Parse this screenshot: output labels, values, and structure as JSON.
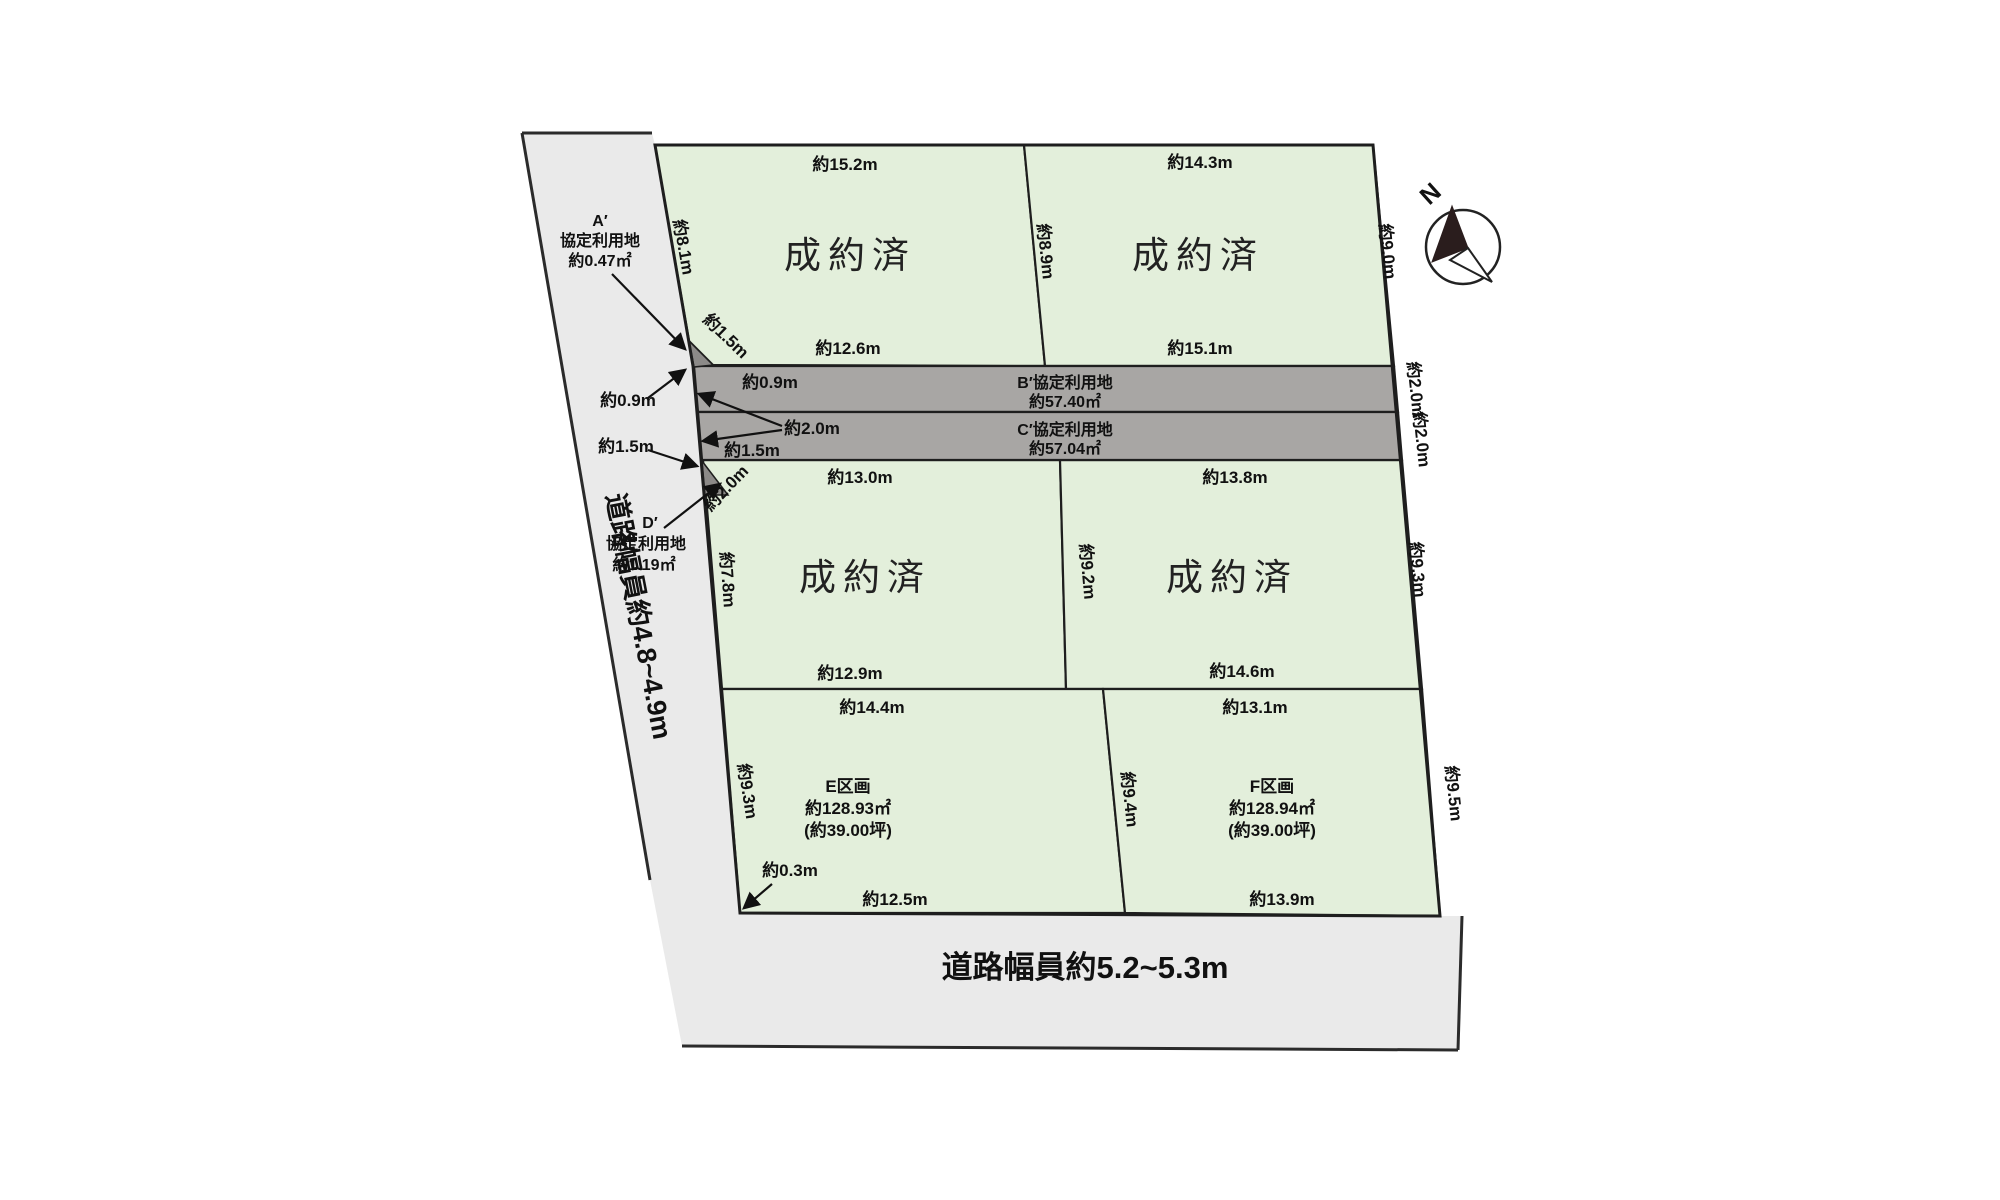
{
  "compass": {
    "north_label": "N"
  },
  "roads": {
    "left_label": "道路幅員約4.8~4.9m",
    "bottom_label": "道路幅員約5.2~5.3m"
  },
  "strips": {
    "b": {
      "name": "B′協定利用地",
      "area": "約57.40㎡",
      "right_width": "約2.0m"
    },
    "c": {
      "name": "C′協定利用地",
      "area": "約57.04㎡",
      "right_width": "約2.0m"
    }
  },
  "corner_lots": {
    "a": {
      "id": "A′",
      "type": "協定利用地",
      "area": "約0.47㎡"
    },
    "d": {
      "id": "D′",
      "type": "協定利用地",
      "area": "約1.19㎡"
    }
  },
  "parcels": {
    "top_left": {
      "status": "成約済",
      "top": "約15.2m",
      "left": "約8.1m",
      "right": "約8.9m",
      "bottom": "約12.6m",
      "corner_cut": "約1.5m"
    },
    "top_right": {
      "status": "成約済",
      "top": "約14.3m",
      "right": "約9.0m",
      "bottom": "約15.1m"
    },
    "mid_left": {
      "status": "成約済",
      "top": "約13.0m",
      "left": "約7.8m",
      "right": "約9.2m",
      "bottom": "約12.9m",
      "corner_cut": "約2.0m"
    },
    "mid_right": {
      "status": "成約済",
      "top": "約13.8m",
      "right": "約9.3m",
      "bottom": "約14.6m"
    },
    "e": {
      "name": "E区画",
      "area": "約128.93㎡",
      "tsubo": "(約39.00坪)",
      "top": "約14.4m",
      "left": "約9.3m",
      "bottom": "約12.5m"
    },
    "f": {
      "name": "F区画",
      "area": "約128.94㎡",
      "tsubo": "(約39.00坪)",
      "top": "約13.1m",
      "left": "約9.4m",
      "right": "約9.5m",
      "bottom": "約13.9m"
    }
  },
  "edge_notes": {
    "left_09": "約0.9m",
    "left_15": "約1.5m",
    "inner_09": "約0.9m",
    "inner_15": "約1.5m",
    "inner_20": "約2.0m",
    "corner_03": "約0.3m"
  }
}
